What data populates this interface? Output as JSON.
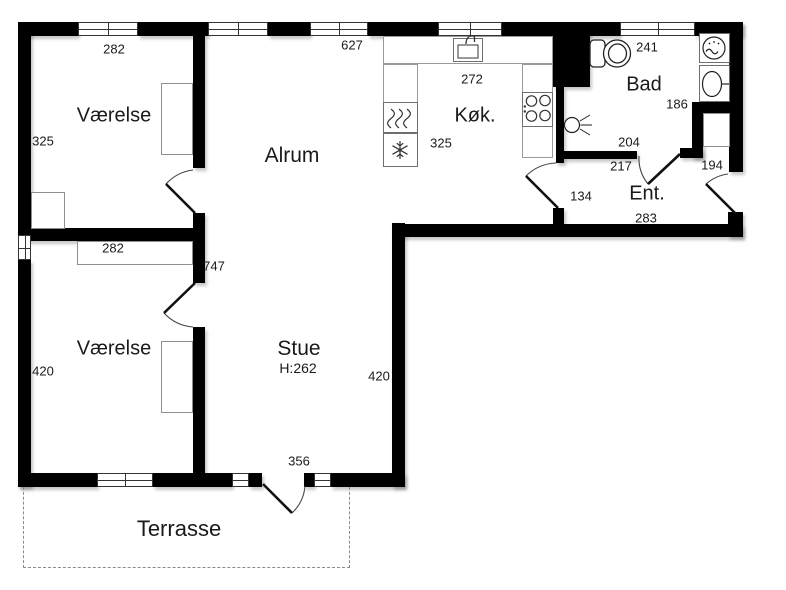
{
  "title": "Floor plan",
  "rooms": {
    "vaerelse1": {
      "label": "Værelse"
    },
    "vaerelse2": {
      "label": "Værelse"
    },
    "alrum": {
      "label": "Alrum"
    },
    "kok": {
      "label": "Køk."
    },
    "bad": {
      "label": "Bad"
    },
    "ent": {
      "label": "Ent."
    },
    "stue": {
      "label": "Stue",
      "ceiling_height": "H:262"
    },
    "terrasse": {
      "label": "Terrasse"
    }
  },
  "dimensions": {
    "vaerelse1_width": "282",
    "alrum_width": "627",
    "kok_inner_width": "272",
    "kok_depth": "325",
    "bad_width": "241",
    "bad_right": "186",
    "bad_bottom": "204",
    "ent_top": "217",
    "ent_right": "194",
    "ent_left": "134",
    "ent_bottom": "283",
    "vaerelse1_height": "325",
    "vaerelse2_closet": "282",
    "open_space_length": "747",
    "vaerelse2_height": "420",
    "stue_height": "420",
    "stue_terrace_wall": "356"
  },
  "icons": [
    "toilet-icon",
    "shower-icon",
    "washbasin-icon",
    "wall-lamp-icon",
    "kitchen-sink-icon",
    "stove-icon",
    "oven-icon",
    "freezer-icon",
    "door-swing",
    "window"
  ],
  "colors": {
    "wall": "#000000",
    "thin_line": "#8f8f8f",
    "background": "#ffffff",
    "text": "#1a1a1a"
  }
}
